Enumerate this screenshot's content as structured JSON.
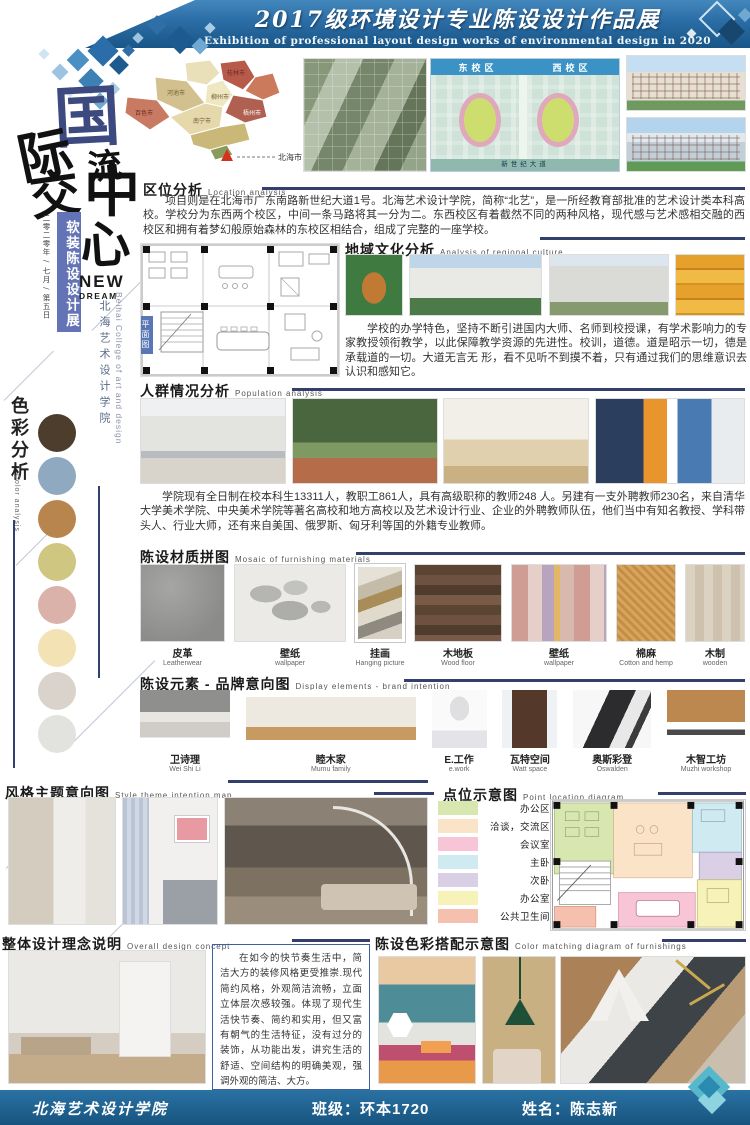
{
  "header": {
    "title": "2017级环境设计专业陈设设计作品展",
    "subtitle": "Exhibition of professional layout design works of environmental design in 2020"
  },
  "sidebar": {
    "calligraphy": [
      "国",
      "际",
      "交",
      "流",
      "中",
      "心"
    ],
    "banner": "软装陈设设计展",
    "date_note": "二零二零年 / 七月 / 第五日",
    "new_word": "NEW",
    "dream_word": "DREAM",
    "college_cn": "北海艺术设计学院",
    "college_en": "Beihai College of art and design",
    "color_analysis": {
      "title_cn": "色彩分析",
      "title_en": "Color analysis",
      "swatches": [
        "#4c3d2d",
        "#8fa9c0",
        "#b9854f",
        "#cfc682",
        "#dab2a9",
        "#f3e2b4",
        "#d9d3cb",
        "#e2e2de"
      ]
    }
  },
  "sections": {
    "location": {
      "title_cn": "区位分析",
      "title_en": "Location analysis",
      "body": "项目则是在北海市广东南路新世纪大道1号。北海艺术设计学院，简称“北艺”，是一所经教育部批准的艺术设计类本科高校。学校分为东西两个校区，中间一条马路将其一分为二。东西校区有着截然不同的两种风格，现代感与艺术感相交融的西校区和拥有着梦幻般原始森林的东校区相结合，组成了完整的一座学校。",
      "map_cities": [
        "桂林市",
        "河池市",
        "柳州市",
        "百色市",
        "南宁市",
        "梧州市"
      ],
      "marker_city": "北海市",
      "campus": {
        "east": "东校区",
        "west": "西校区",
        "road": "新世纪大道"
      }
    },
    "culture": {
      "title_cn": "地域文化分析",
      "title_en": "Analysis of regional culture",
      "plan_label": "平面图",
      "body": "学校的办学特色，坚持不断引进国内大师、名师到校授课，有学术影响力的专家教授领衔教学，以此保障教学资源的先进性。校训，道德。道是昭示一切，德是承载道的一切。大道无言无 形，看不见听不到摸不着，只有通过我们的思维意识去认识和感知它。"
    },
    "population": {
      "title_cn": "人群情况分析",
      "title_en": "Population analysis",
      "body": "学院现有全日制在校本科生13311人，教职工861人，具有高级职称的教师248 人。另建有一支外聘教师230名，来自清华大学美术学院、中央美术学院等著名高校和地方高校以及艺术设计行业、企业的外聘教师队伍，他们当中有知名教授、学科带头人、行业大师，还有来自美国、俄罗斯、匈牙利等国的外籍专业教师。"
    },
    "materials": {
      "title_cn": "陈设材质拼图",
      "title_en": "Mosaic of furnishing materials",
      "items": [
        {
          "cn": "皮革",
          "en": "Leatherwear"
        },
        {
          "cn": "壁纸",
          "en": "wallpaper"
        },
        {
          "cn": "挂画",
          "en": "Hanging picture"
        },
        {
          "cn": "木地板",
          "en": "Wood floor"
        },
        {
          "cn": "壁纸",
          "en": "wallpaper"
        },
        {
          "cn": "棉麻",
          "en": "Cotton and hemp"
        },
        {
          "cn": "木制",
          "en": "wooden"
        }
      ]
    },
    "brands": {
      "title_cn": "陈设元素 - 品牌意向图",
      "title_en": "Display elements - brand intention",
      "items": [
        {
          "cn": "卫诗理",
          "en": "Wei Shi Li"
        },
        {
          "cn": "睦木家",
          "en": "Mumu family"
        },
        {
          "cn": "E.工作",
          "en": "e.work"
        },
        {
          "cn": "瓦特空间",
          "en": "Watt space"
        },
        {
          "cn": "奥斯彩登",
          "en": "Oswalden"
        },
        {
          "cn": "木智工坊",
          "en": "Muzhi workshop"
        }
      ]
    },
    "style": {
      "title_cn": "风格主题意向图",
      "title_en": "Style theme intention map"
    },
    "points": {
      "title_cn": "点位示意图",
      "title_en": "Point location diagram",
      "legend": [
        {
          "label": "办公区",
          "color": "#d8e6b0"
        },
        {
          "label": "洽谈，交流区",
          "color": "#fbe3c8"
        },
        {
          "label": "会议室",
          "color": "#f7c5d5"
        },
        {
          "label": "主卧",
          "color": "#cfeaf0"
        },
        {
          "label": "次卧",
          "color": "#d9d0e6"
        },
        {
          "label": "办公室",
          "color": "#f7f3b8"
        },
        {
          "label": "公共卫生间",
          "color": "#f5c0ad"
        }
      ]
    },
    "concept": {
      "title_cn": "整体设计理念说明",
      "title_en": "Overall design concept",
      "body": "在如今的快节奏生活中，简洁大方的装修风格更受推崇.现代简约风格，外观简洁流畅，立面立体层次感较强。体现了现代生活快节奏、简约和实用，但又富有朝气的生活特征，没有过分的装饰，从功能出发，讲究生活的舒适、空间结构的明确美观，强调外观的简洁、大方。"
    },
    "color_match": {
      "title_cn": "陈设色彩搭配示意图",
      "title_en": "Color matching diagram of furnishings"
    }
  },
  "footer": {
    "college": "北海艺术设计学院",
    "class_label": "班级：",
    "class_value": "环本1720",
    "name_label": "姓名：",
    "name_value": "陈志新"
  },
  "colors": {
    "header_blue": "#2a6ca5",
    "footer_blue": "#1c608f",
    "accent_navy": "#33406e",
    "banner_blue": "#6373b5"
  }
}
